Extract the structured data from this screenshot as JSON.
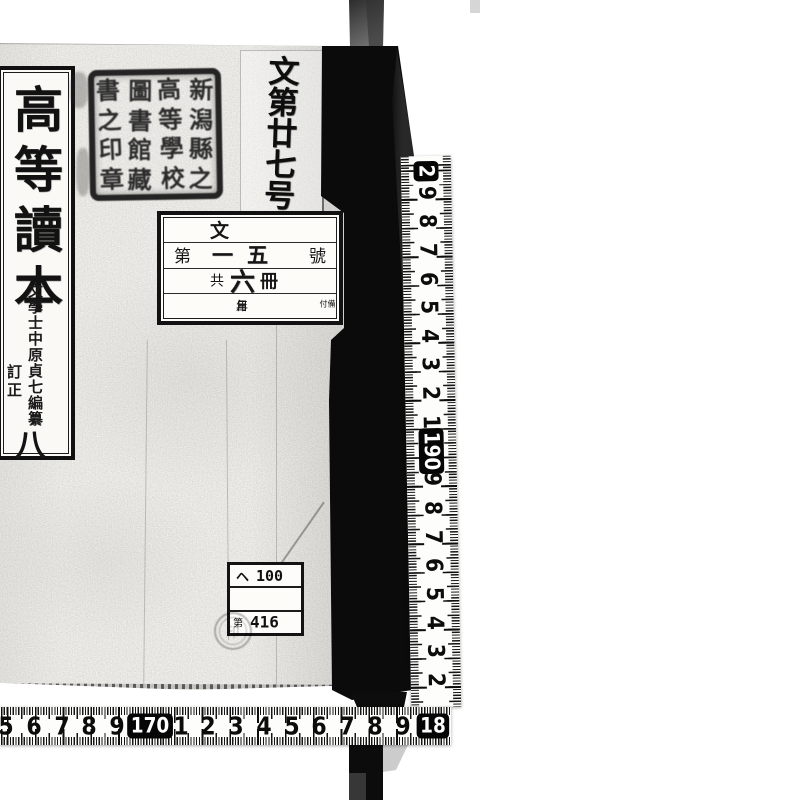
{
  "page": {
    "background": "#ffffff"
  },
  "book": {
    "cover_color": "#f5f4f0",
    "spine_color": "#0b0b0b",
    "title_label": {
      "title": "高等讀本",
      "editor": "文學士中原貞七編纂",
      "revision": "訂正",
      "volume": "八"
    },
    "classification_slip": {
      "text": "文第廿七号"
    },
    "library_seal": {
      "columns": [
        "新潟縣之",
        "高等學校",
        "圖書館藏",
        "書之印章"
      ]
    },
    "catalog_label": {
      "category": "文",
      "number_prefix": "第",
      "number": "一五",
      "number_suffix": "號",
      "copies_prefix": "共",
      "copies": "六",
      "copies_suffix": "冊",
      "date_fields": [
        "年",
        "月",
        "日"
      ],
      "note": "備付"
    },
    "call_number_label": {
      "line1_letter": "ヘ",
      "line1_number": "100",
      "line2": "",
      "line3_prefix": "第",
      "line3_number": "416"
    },
    "round_stamp_glyph": "印"
  },
  "rulers": {
    "unit": "cm",
    "vertical": {
      "marks": [
        {
          "label": "2",
          "boxed": true
        },
        {
          "label": "9"
        },
        {
          "label": "8"
        },
        {
          "label": "7"
        },
        {
          "label": "6"
        },
        {
          "label": "5"
        },
        {
          "label": "4"
        },
        {
          "label": "3"
        },
        {
          "label": "2"
        },
        {
          "label": "1"
        },
        {
          "label": "190",
          "boxed": true
        },
        {
          "label": "9"
        },
        {
          "label": "8"
        },
        {
          "label": "7"
        },
        {
          "label": "6"
        },
        {
          "label": "5"
        },
        {
          "label": "4"
        },
        {
          "label": "3"
        },
        {
          "label": "2"
        }
      ]
    },
    "horizontal": {
      "marks": [
        {
          "label": "5"
        },
        {
          "label": "6"
        },
        {
          "label": "7"
        },
        {
          "label": "8"
        },
        {
          "label": "9"
        },
        {
          "label": "170",
          "boxed": true
        },
        {
          "label": "1"
        },
        {
          "label": "2"
        },
        {
          "label": "3"
        },
        {
          "label": "4"
        },
        {
          "label": "5"
        },
        {
          "label": "6"
        },
        {
          "label": "7"
        },
        {
          "label": "8"
        },
        {
          "label": "9"
        },
        {
          "label": "18",
          "boxed": true
        }
      ]
    }
  }
}
